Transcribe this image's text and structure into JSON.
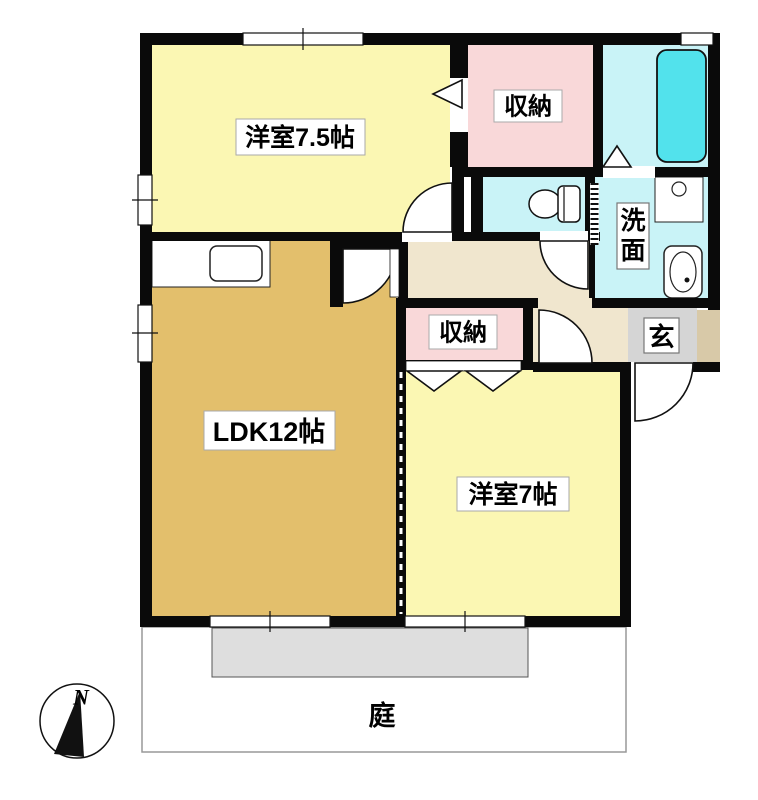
{
  "plan": {
    "title": "2LDK apartment floor plan",
    "labels": {
      "room75": "洋室7.5帖",
      "closet_top": "収納",
      "closet_mid": "収納",
      "washroom_char1": "洗",
      "washroom_char2": "面",
      "genkan": "玄",
      "ldk": "LDK12帖",
      "room7": "洋室7帖",
      "garden": "庭",
      "compass_north": "N"
    },
    "colors": {
      "room_yellow": "#FBF7B3",
      "ldk_tan": "#E3BF6C",
      "closet_pink": "#F9D8D9",
      "wet_cyan": "#C9F3F7",
      "bathtub_cyan": "#52E2EC",
      "hall_beige": "#F0E6CE",
      "genkan_gray": "#D5D5D5",
      "porch_tan": "#D8C9A8",
      "deck_gray": "#DEDEDE",
      "wall_black": "#0A0A0A"
    }
  }
}
